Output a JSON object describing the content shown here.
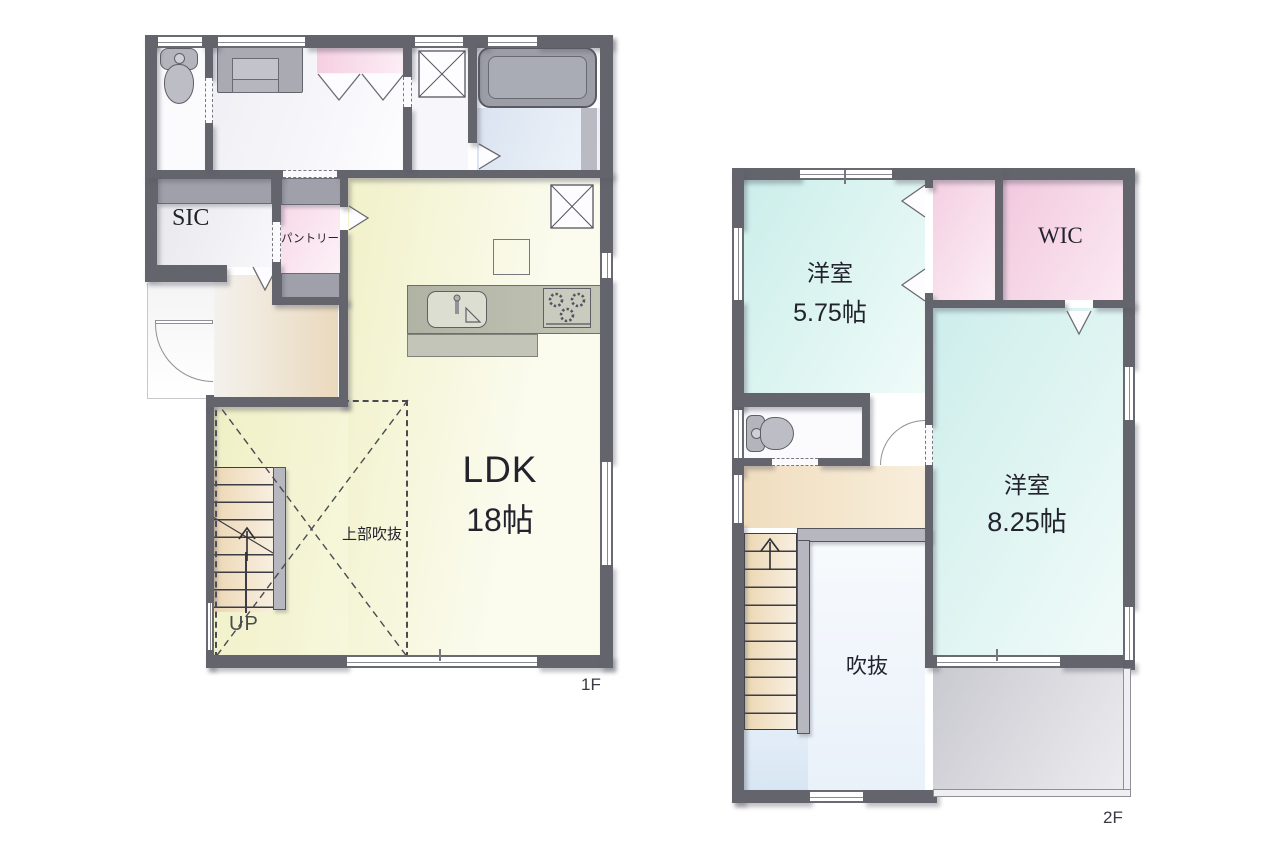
{
  "floor1": {
    "label": "1F",
    "rooms": {
      "ldk": {
        "name": "LDK",
        "size": "18帖"
      },
      "sic": {
        "name": "SIC"
      },
      "pantry": {
        "name": "パントリー"
      },
      "open_ceiling": {
        "name": "上部吹抜"
      },
      "stairs": {
        "label": "UP"
      }
    }
  },
  "floor2": {
    "label": "2F",
    "rooms": {
      "bedroom_a": {
        "name": "洋室",
        "size": "5.75帖"
      },
      "wic": {
        "name": "WIC"
      },
      "bedroom_b": {
        "name": "洋室",
        "size": "8.25帖"
      },
      "void": {
        "name": "吹抜"
      }
    }
  },
  "colors": {
    "wall": "#64646c",
    "ldk_floor": "#f4f4d3",
    "bedroom_floor": "#d5f0ed",
    "closet_pink": "#f6d4e5",
    "entrance_tan": "#eedcbd",
    "bath_blue": "#dde7f2",
    "balcony_gray": "#d6d6dc"
  }
}
